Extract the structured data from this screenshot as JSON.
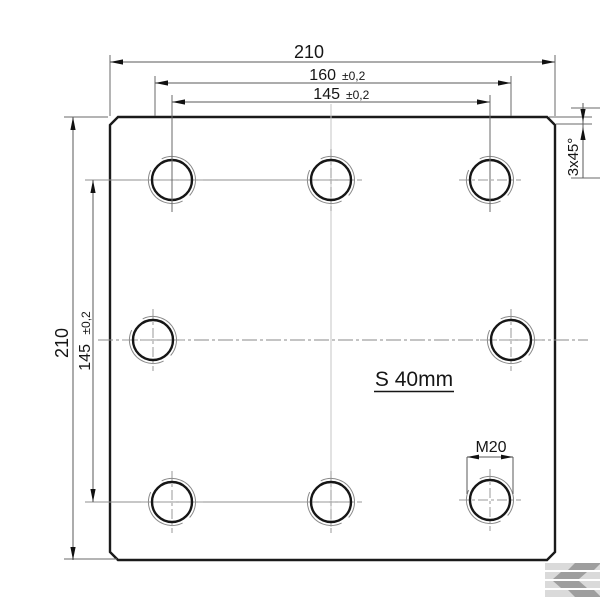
{
  "drawing": {
    "type": "technical-drawing-plate-top-view",
    "labels": {
      "overall_width": "210",
      "mid_hole_spacing_value": "160",
      "mid_hole_spacing_tol": "±0,2",
      "outer_hole_spacing_value": "145",
      "outer_hole_spacing_tol": "±0,2",
      "overall_height": "210",
      "vertical_hole_spacing_value": "145",
      "vertical_hole_spacing_tol": "±0,2",
      "thickness": "S 40mm",
      "thread_size": "M20",
      "chamfer": "3x45°"
    },
    "holes": {
      "count": 8,
      "thread": "M20",
      "rows": 3
    },
    "colors": {
      "outline": "#1a1a1a",
      "dimension_lines": "#5a5a5a",
      "centerlines": "#9a9a9a",
      "watermark_light": "#dadada",
      "watermark_dark": "#9e9e9e",
      "background": "#ffffff"
    },
    "watermark": "kramp-k-logo-icon"
  }
}
